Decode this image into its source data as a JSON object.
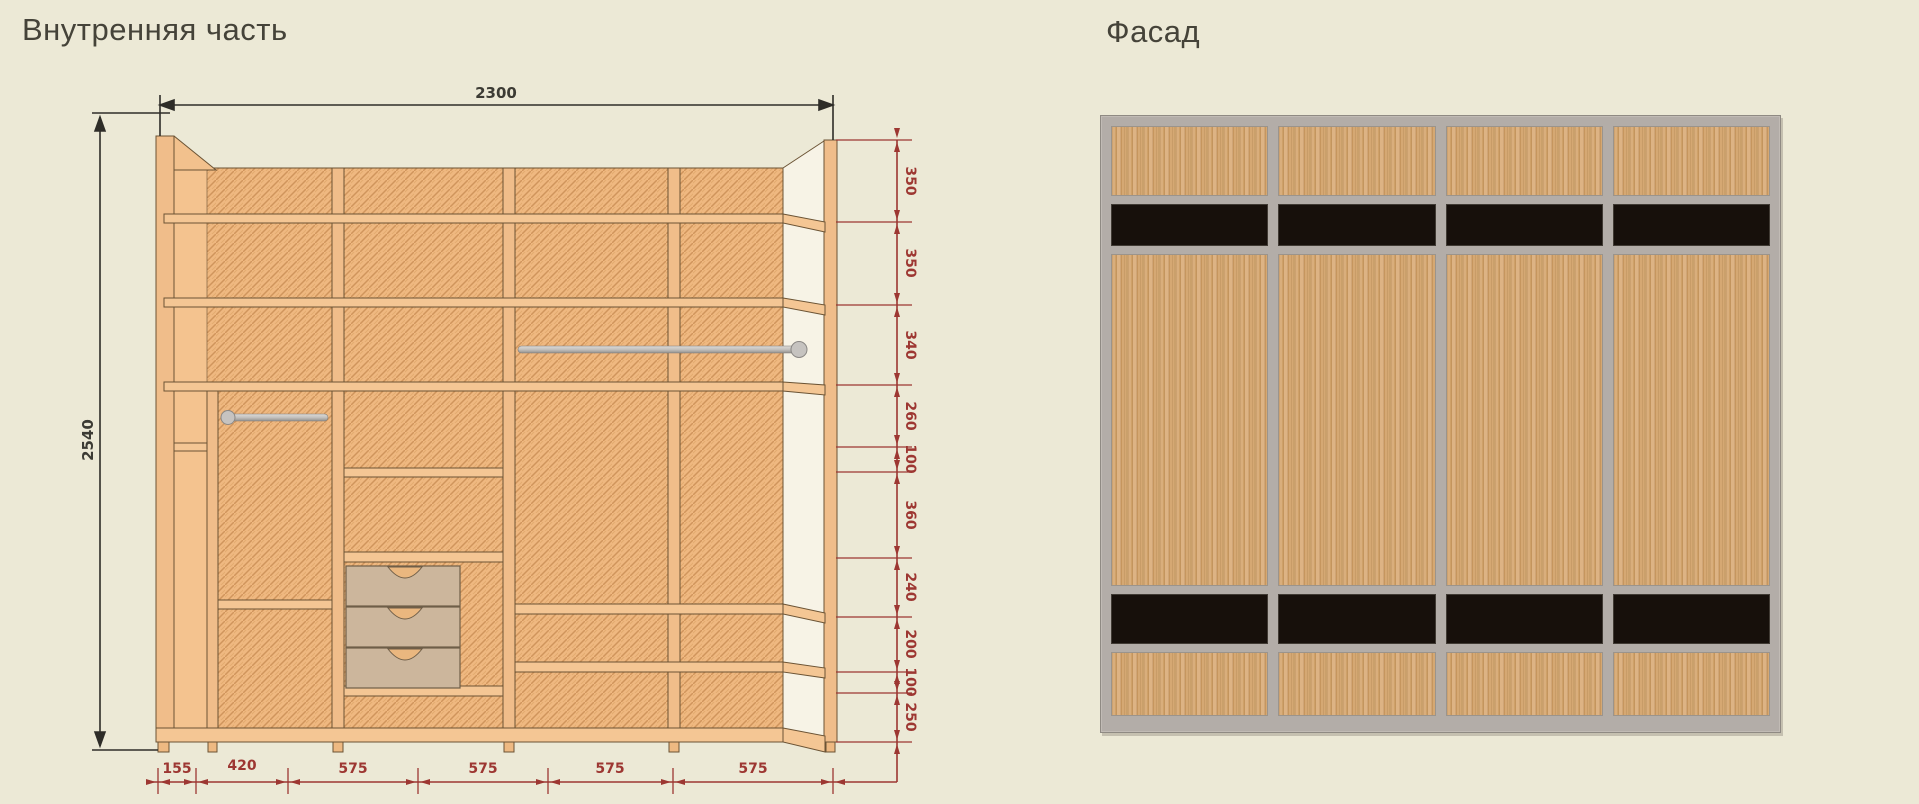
{
  "colors": {
    "background": "#ece9d6",
    "dim_red": "#9d3732",
    "dim_dark": "#3c3b34",
    "facade_frame": "#b3ada8",
    "facade_black": "#17100b",
    "facade_wood": "#d4a977",
    "plank_wood": "#f2c18d",
    "hatch_base": "#efb880"
  },
  "internal": {
    "title": "Внутренняя часть",
    "width_label": "2300",
    "height_label": "2540",
    "right_dims": [
      "350",
      "350",
      "340",
      "260",
      "100",
      "360",
      "240",
      "200",
      "100",
      "250"
    ],
    "bottom_dims": [
      "155",
      "420",
      "575",
      "575",
      "575",
      "575"
    ]
  },
  "facade": {
    "title": "Фасад",
    "door_count": 4,
    "rows": [
      "wood",
      "black",
      "wood",
      "black",
      "wood"
    ]
  }
}
